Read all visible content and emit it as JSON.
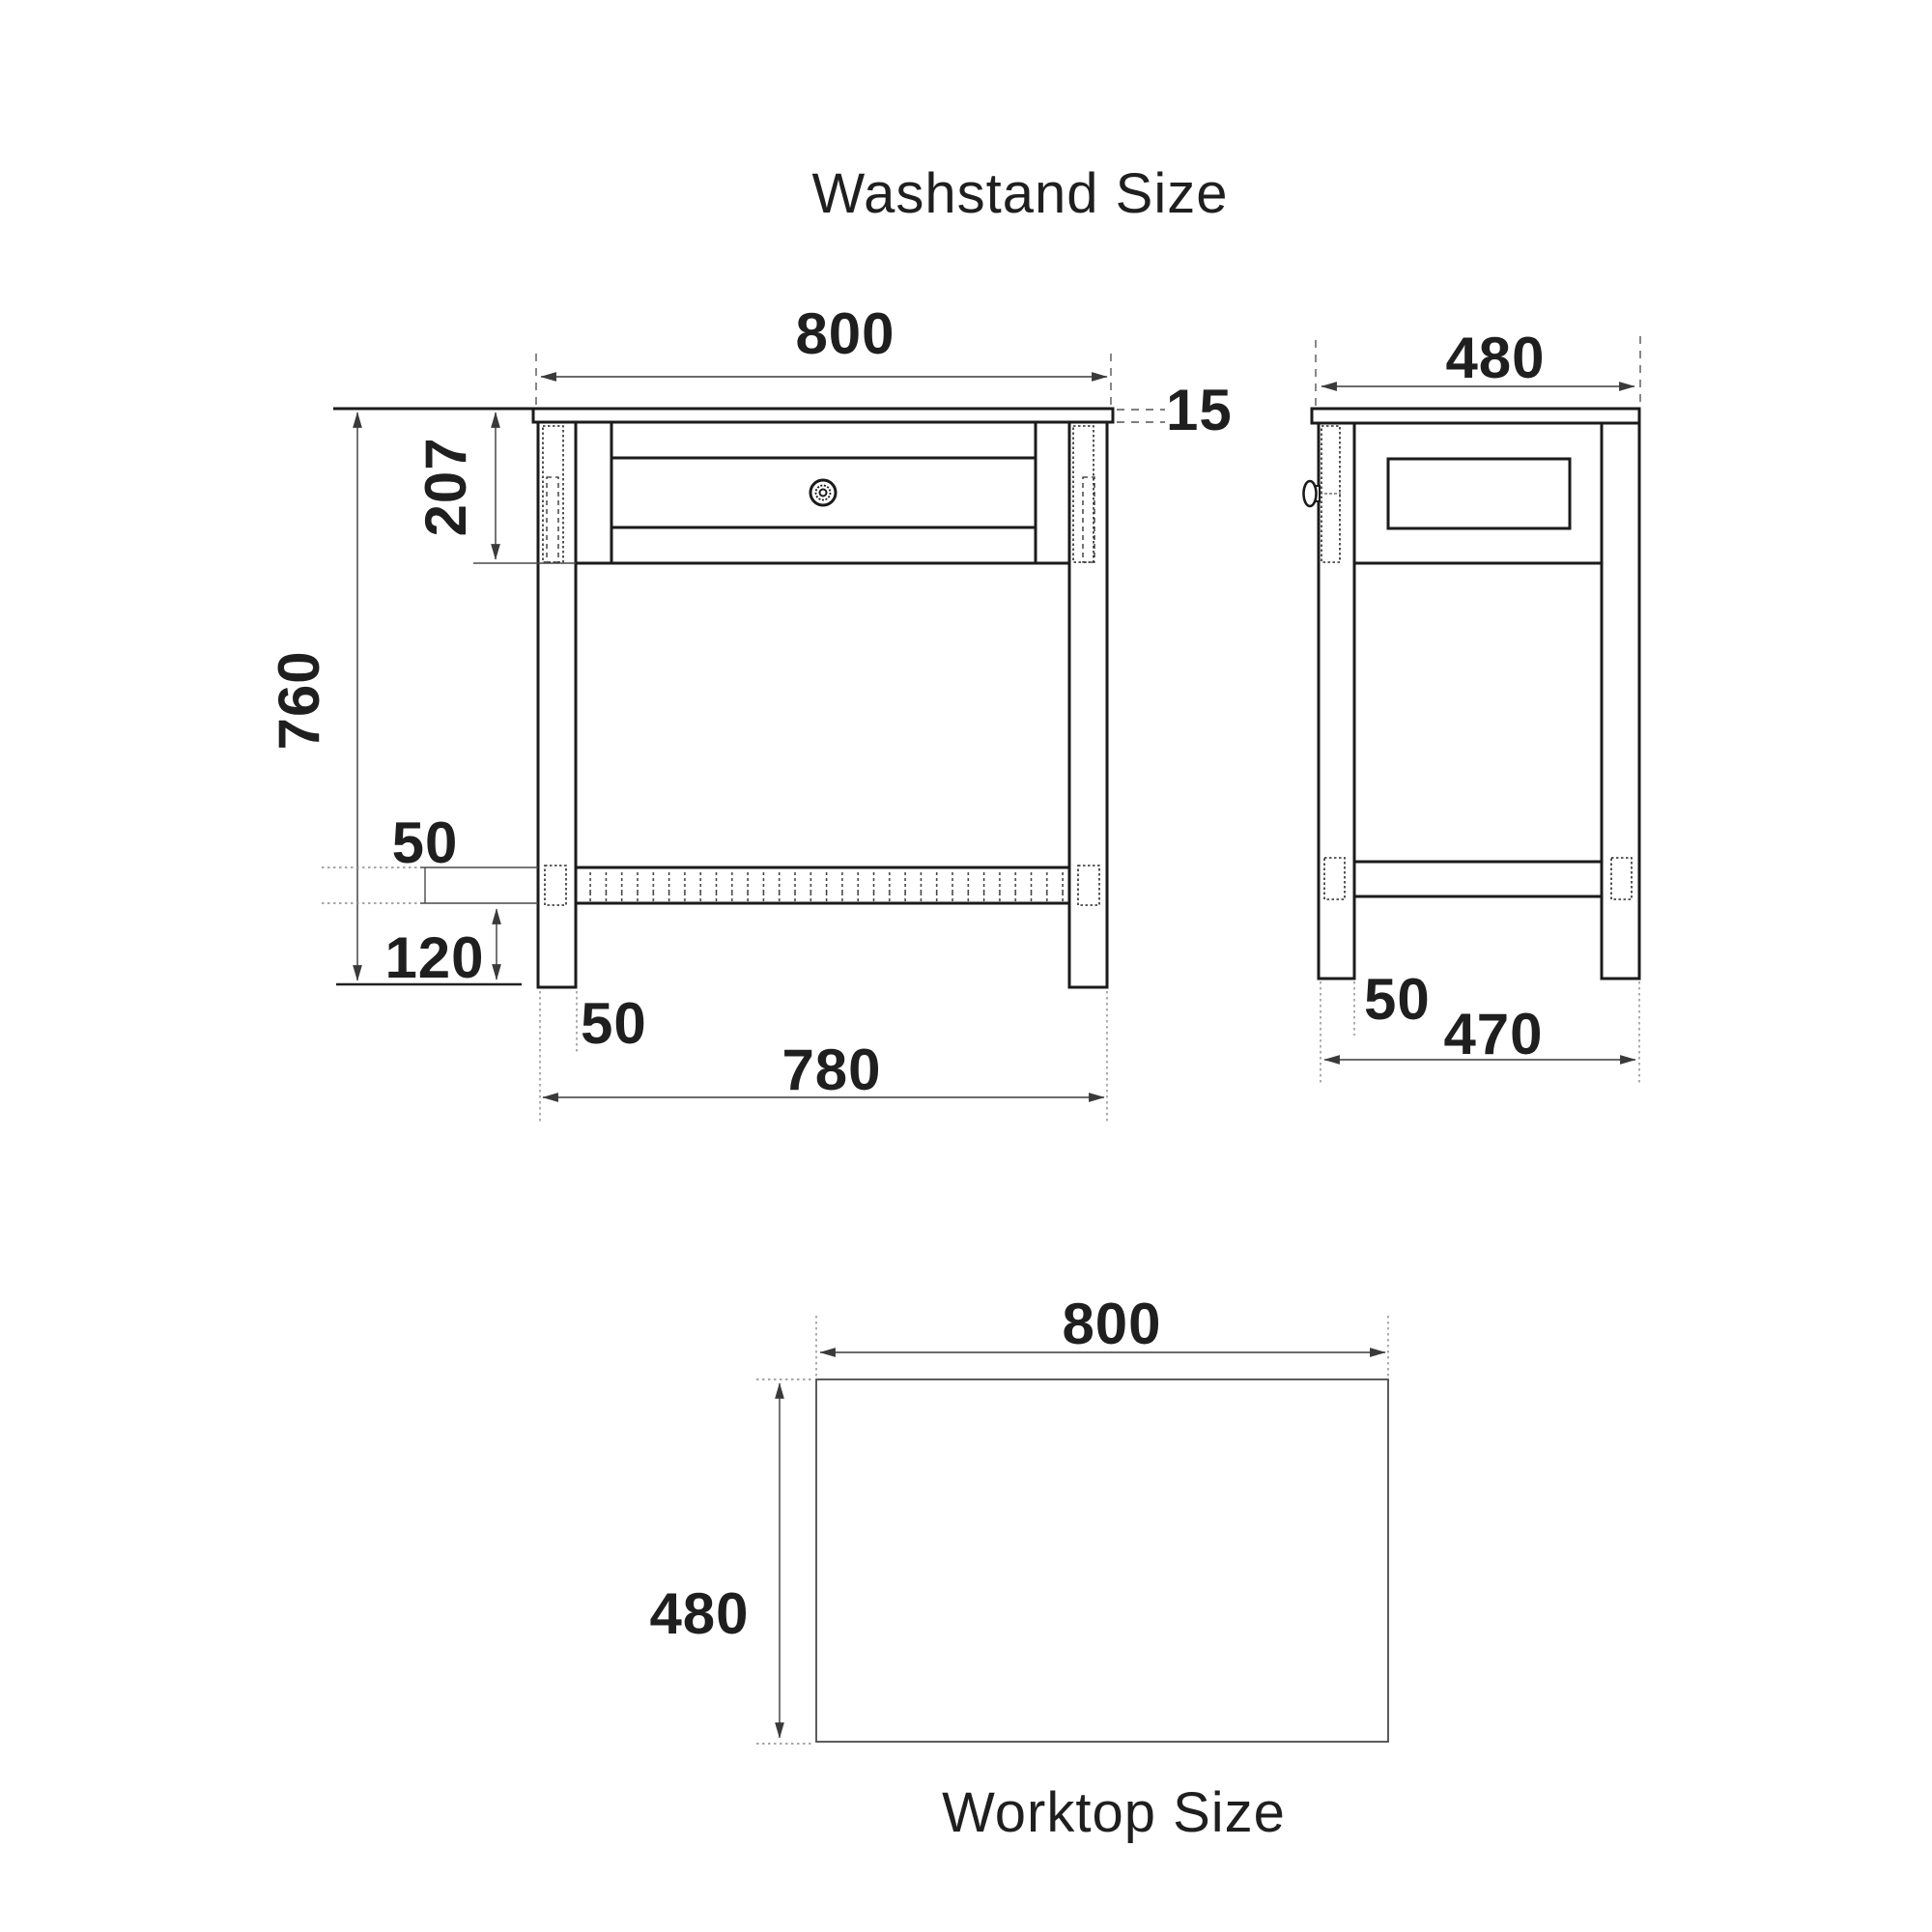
{
  "title": "Washstand Size",
  "worktop_title": "Worktop Size",
  "front": {
    "worktop_width": "800",
    "worktop_thickness": "15",
    "apron_height": "207",
    "total_height": "760",
    "shelf_thickness": "50",
    "shelf_to_floor": "120",
    "leg_width": "50",
    "outer_leg_span": "780"
  },
  "side": {
    "worktop_depth": "480",
    "leg_width": "50",
    "outer_leg_span": "470"
  },
  "plan": {
    "width": "800",
    "depth": "480"
  },
  "colors": {
    "background": "#ffffff",
    "drawing_line": "#1b1b1b",
    "dimension_line": "#3a3a3a",
    "extension_line": "#8a8a8a",
    "text": "#1f1f1f"
  }
}
